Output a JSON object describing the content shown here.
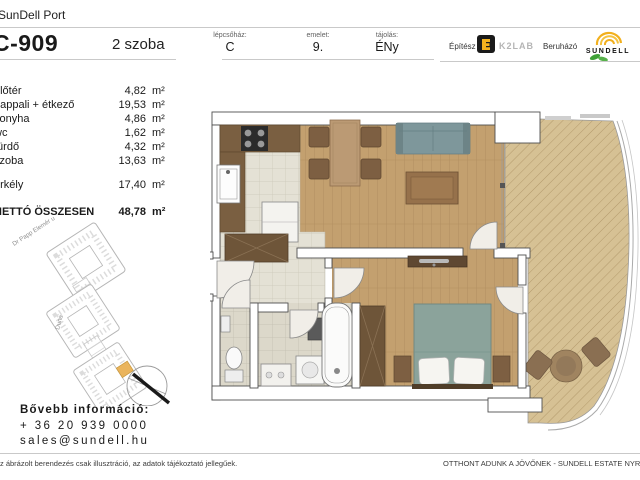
{
  "header": {
    "brand": "SunDell Port",
    "unit_id": "C-909",
    "unit_type": "2 szoba",
    "meta": [
      {
        "label": "lépcsőház:",
        "value": "C"
      },
      {
        "label": "emelet:",
        "value": "9."
      },
      {
        "label": "tájolás:",
        "value": "ÉNy"
      }
    ],
    "architect_label": "Építész",
    "architect_name": "K2LAB",
    "developer_label": "Beruházó",
    "developer_name": "SUNDELL"
  },
  "rooms": {
    "unit_sq": "m²",
    "items": [
      {
        "name": "előtér",
        "area": "4,82"
      },
      {
        "name": "nappali + étkező",
        "area": "19,53"
      },
      {
        "name": "konyha",
        "area": "4,86"
      },
      {
        "name": "wc",
        "area": "1,62"
      },
      {
        "name": "fürdő",
        "area": "4,32"
      },
      {
        "name": "szoba",
        "area": "13,63"
      }
    ],
    "balcony": {
      "name": "erkély",
      "area": "17,40"
    },
    "total": {
      "name": "NETTÓ ÖSSZESEN",
      "area": "48,78"
    }
  },
  "site_plan": {
    "street1": "Dr Papp Elemér u",
    "street2": "Duna"
  },
  "contact": {
    "title": "Bővebb információ:",
    "phone": "+ 36 20 939 0000",
    "email": "sales@sundell.hu"
  },
  "footer": {
    "disclaimer": "Az ábrázolt berendezés csak illusztráció, az adatok tájékoztató jellegűek.",
    "slogan": "OTTHONT ADUNK A JÖVŐNEK - SUNDELL ESTATE NYRT."
  },
  "colors": {
    "accent_yellow": "#f2b01e",
    "logo_green": "#3fa037",
    "k2lab_black": "#1a1a1a",
    "site_highlight_orange": "#eab45c",
    "wood_floor": "#c3a06f",
    "balcony_deck": "#d6c194",
    "tile_floor": "#e4e1d5",
    "sofa_teal": "#7e979b",
    "bed_teal": "#8ba39b",
    "counter_brown": "#7a5f41",
    "wall_outline": "#4f4f4f"
  }
}
